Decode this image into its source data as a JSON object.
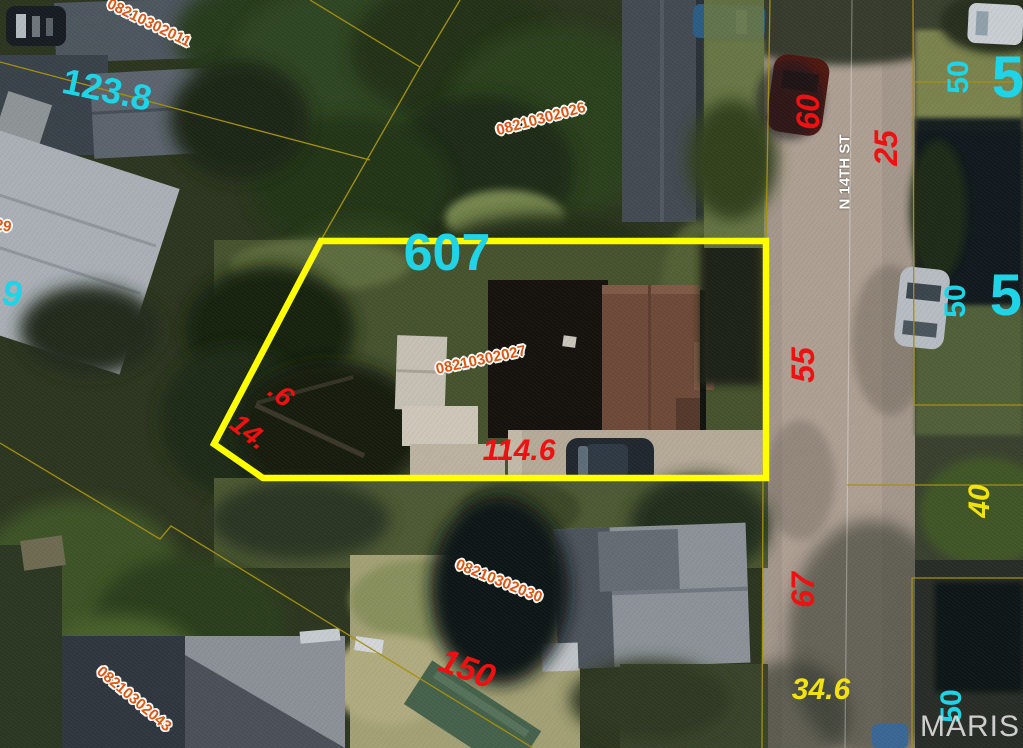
{
  "map": {
    "watermark": "MARIS",
    "street_name": "N 14TH ST",
    "highlighted_parcel": {
      "id": "08210302027",
      "house_number": "607",
      "outline_color": "#ffff00",
      "outline_points": [
        [
          321,
          241
        ],
        [
          766,
          241
        ],
        [
          766,
          478
        ],
        [
          263,
          478
        ],
        [
          214,
          444
        ]
      ]
    },
    "colors": {
      "parcel_id": "#e0550f",
      "red": "#ee1111",
      "cyan": "#1fd4e6",
      "yellow": "#f2e20e",
      "street": "#ffffff",
      "watermark": "#dcdcdc",
      "cadastral_line": "#a5900f",
      "road_centerline": "rgba(255,255,255,0.32)",
      "parcel_outline": "#ffff00"
    }
  },
  "labels": [
    {
      "name": "parcel-id-08210302011",
      "text": "08210302011",
      "x": 149,
      "y": 23,
      "rot": 26,
      "size": 15,
      "color": "parcel_id",
      "outline": true
    },
    {
      "name": "dim-123-8",
      "text": "123.8",
      "x": 107,
      "y": 90,
      "rot": 12,
      "size": 36,
      "color": "cyan"
    },
    {
      "name": "parcel-id-08210302026",
      "text": "08210302026",
      "x": 541,
      "y": 119,
      "rot": -15,
      "size": 15,
      "color": "parcel_id",
      "outline": true
    },
    {
      "name": "house-number-607",
      "text": "607",
      "x": 447,
      "y": 253,
      "rot": 0,
      "size": 52,
      "color": "cyan"
    },
    {
      "name": "parcel-id-08210302027",
      "text": "08210302027",
      "x": 481,
      "y": 360,
      "rot": -12,
      "size": 15,
      "color": "parcel_id",
      "outline": true
    },
    {
      "name": "dim-point-6",
      "text": ".6",
      "x": 281,
      "y": 394,
      "rot": 38,
      "size": 28,
      "color": "red",
      "it": true
    },
    {
      "name": "dim-14",
      "text": "14.",
      "x": 249,
      "y": 432,
      "rot": 38,
      "size": 28,
      "color": "red",
      "it": true
    },
    {
      "name": "dim-114-6",
      "text": "114.6",
      "x": 519,
      "y": 451,
      "rot": 0,
      "size": 30,
      "color": "red",
      "it": true
    },
    {
      "name": "parcel-id-08210302030",
      "text": "08210302030",
      "x": 499,
      "y": 581,
      "rot": 22,
      "size": 15,
      "color": "parcel_id",
      "outline": true
    },
    {
      "name": "dim-150",
      "text": "150",
      "x": 467,
      "y": 669,
      "rot": 20,
      "size": 34,
      "color": "red",
      "it": true
    },
    {
      "name": "parcel-id-08210302043",
      "text": "08210302043",
      "x": 134,
      "y": 699,
      "rot": 40,
      "size": 15,
      "color": "parcel_id",
      "outline": true
    },
    {
      "name": "dim-60",
      "text": "60",
      "x": 808,
      "y": 112,
      "rot": -90,
      "size": 32,
      "color": "red",
      "it": true
    },
    {
      "name": "dim-25",
      "text": "25",
      "x": 886,
      "y": 148,
      "rot": -90,
      "size": 32,
      "color": "red",
      "it": true
    },
    {
      "name": "dim-50-ne",
      "text": "50",
      "x": 959,
      "y": 77,
      "rot": -90,
      "size": 30,
      "color": "cyan"
    },
    {
      "name": "house-number-50-ne",
      "text": "50",
      "x": 1024,
      "y": 78,
      "rot": 0,
      "size": 58,
      "color": "cyan"
    },
    {
      "name": "dim-55",
      "text": "55",
      "x": 803,
      "y": 365,
      "rot": -90,
      "size": 32,
      "color": "red",
      "it": true
    },
    {
      "name": "dim-50-e",
      "text": "50",
      "x": 956,
      "y": 301,
      "rot": -90,
      "size": 30,
      "color": "cyan"
    },
    {
      "name": "house-number-50-e",
      "text": "50",
      "x": 1022,
      "y": 296,
      "rot": 0,
      "size": 58,
      "color": "cyan"
    },
    {
      "name": "dim-40",
      "text": "40",
      "x": 980,
      "y": 501,
      "rot": -90,
      "size": 30,
      "color": "yellow",
      "it": true
    },
    {
      "name": "dim-67",
      "text": "67",
      "x": 803,
      "y": 590,
      "rot": -90,
      "size": 32,
      "color": "red",
      "it": true
    },
    {
      "name": "dim-34-6",
      "text": "34.6",
      "x": 821,
      "y": 690,
      "rot": 0,
      "size": 30,
      "color": "yellow",
      "it": true
    },
    {
      "name": "dim-50-se",
      "text": "50",
      "x": 952,
      "y": 706,
      "rot": -90,
      "size": 30,
      "color": "cyan"
    },
    {
      "name": "dim-4-9-fragment",
      "text": "4.9",
      "x": -2,
      "y": 290,
      "rot": 15,
      "size": 36,
      "color": "cyan"
    },
    {
      "name": "parcel-id-fragment-29",
      "text": "29",
      "x": 3,
      "y": 226,
      "rot": 10,
      "size": 15,
      "color": "parcel_id",
      "outline": true
    }
  ],
  "cadastral_lines": [
    [
      [
        0,
        62
      ],
      [
        370,
        160
      ]
    ],
    [
      [
        310,
        0
      ],
      [
        420,
        67
      ]
    ],
    [
      [
        460,
        0
      ],
      [
        420,
        67
      ]
    ],
    [
      [
        420,
        67
      ],
      [
        321,
        240
      ]
    ],
    [
      [
        770,
        0
      ],
      [
        766,
        240
      ],
      [
        763,
        478
      ],
      [
        762,
        748
      ]
    ],
    [
      [
        913,
        0
      ],
      [
        914,
        405
      ],
      [
        1023,
        405
      ]
    ],
    [
      [
        913,
        82
      ],
      [
        1023,
        82
      ]
    ],
    [
      [
        847,
        485
      ],
      [
        1023,
        485
      ]
    ],
    [
      [
        1023,
        578
      ],
      [
        912,
        578
      ],
      [
        912,
        748
      ]
    ],
    [
      [
        0,
        443
      ],
      [
        160,
        539
      ],
      [
        171,
        526
      ],
      [
        533,
        748
      ]
    ]
  ],
  "road_centerline": [
    [
      852,
      0
    ],
    [
      845,
      748
    ]
  ]
}
